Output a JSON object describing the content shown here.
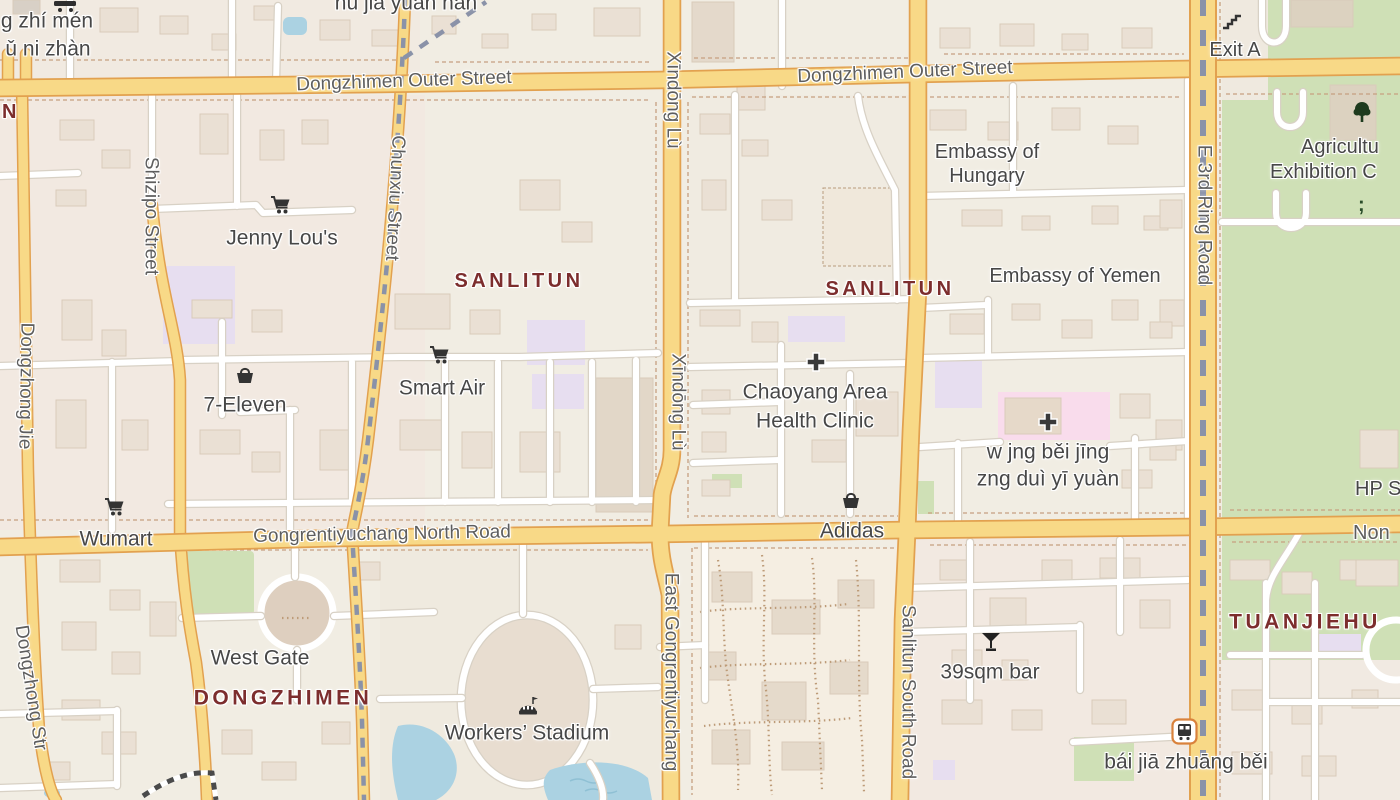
{
  "labels": {
    "partial_top_left_1": "g zhí mén",
    "partial_top_left_2": "ǔ ni zhàn",
    "hu_jia_yuan_nan": "hù jiā yuán nán",
    "dongzhimen_outer_west": "Dongzhimen Outer Street",
    "dongzhimen_outer_east": "Dongzhimen Outer Street",
    "exit_a": "Exit A",
    "embassy_hungary_1": "Embassy of",
    "embassy_hungary_2": "Hungary",
    "agricultural_1": "Agricultu",
    "agricultural_2": "Exhibition C",
    "embassy_yemen": "Embassy of Yemen",
    "sanlitun_west": "SANLITUN",
    "sanlitun_east": "SANLITUN",
    "jenny_lous": "Jenny Lou's",
    "shizipo_street": "Shizipo Street",
    "chunxiu_street": "Chunxiu Street",
    "dongzhong_jie": "Dongzhong Jie",
    "dongzhong_str": "Dongzhong Str",
    "seven_eleven": "7-Eleven",
    "smart_air": "Smart Air",
    "xindong_lu_north": "Xīndōng Lù",
    "xindong_lu_south": "Xīndōng Lù",
    "chaoyang_clinic_1": "Chaoyang Area",
    "chaoyang_clinic_2": "Health Clinic",
    "hospital_pinyin_1": "w jng běi jīng",
    "hospital_pinyin_2": "zng duì yī yuàn",
    "hp_s": "HP S",
    "wumart": "Wumart",
    "gongrentiyuchang_north_road": "Gongrentiyuchang North Road",
    "adidas": "Adidas",
    "non": "Non",
    "sanlitun_south_road": "Sanlitun South Road",
    "east_gongrentiyuchang": "East Gongrentiyuchang",
    "e_3rd_ring_road": "E 3rd Ring Road",
    "west_gate": "West Gate",
    "dongzhimen_district": "DONGZHIMEN",
    "workers_stadium": "Workers’ Stadium",
    "bar_39sqm": "39sqm bar",
    "tuanjiehu": "TUANJIEHU",
    "bai_jia_zhuang_bei": "bái jiā zhuāng běi",
    "n_partial": "N",
    "semicolon_glyph": ";"
  },
  "icons": {
    "supermarket": "shopping-cart",
    "convenience": "shopping-basket",
    "clinic": "medical-cross",
    "bar": "cocktail-glass",
    "bus_stop": "bus",
    "park_tree": "tree",
    "stadium": "stadium-dome-flag",
    "subway_exit": "stairs",
    "small_amenity": "semicolon-glyph"
  },
  "colors": {
    "background": "#f1ede3",
    "road_fill": "#f8d987",
    "road_casing": "#e2a14f",
    "minor_road": "#ffffff",
    "park": "#cfe0b6",
    "water": "#abd2e2",
    "building": "#eae0d4",
    "school_area": "#e7def0",
    "hospital_area": "#f9dcec",
    "district_label": "#7c2d2d",
    "poi_label": "#474747",
    "road_label": "#5e5e5e",
    "railway": "#8a92a8"
  }
}
